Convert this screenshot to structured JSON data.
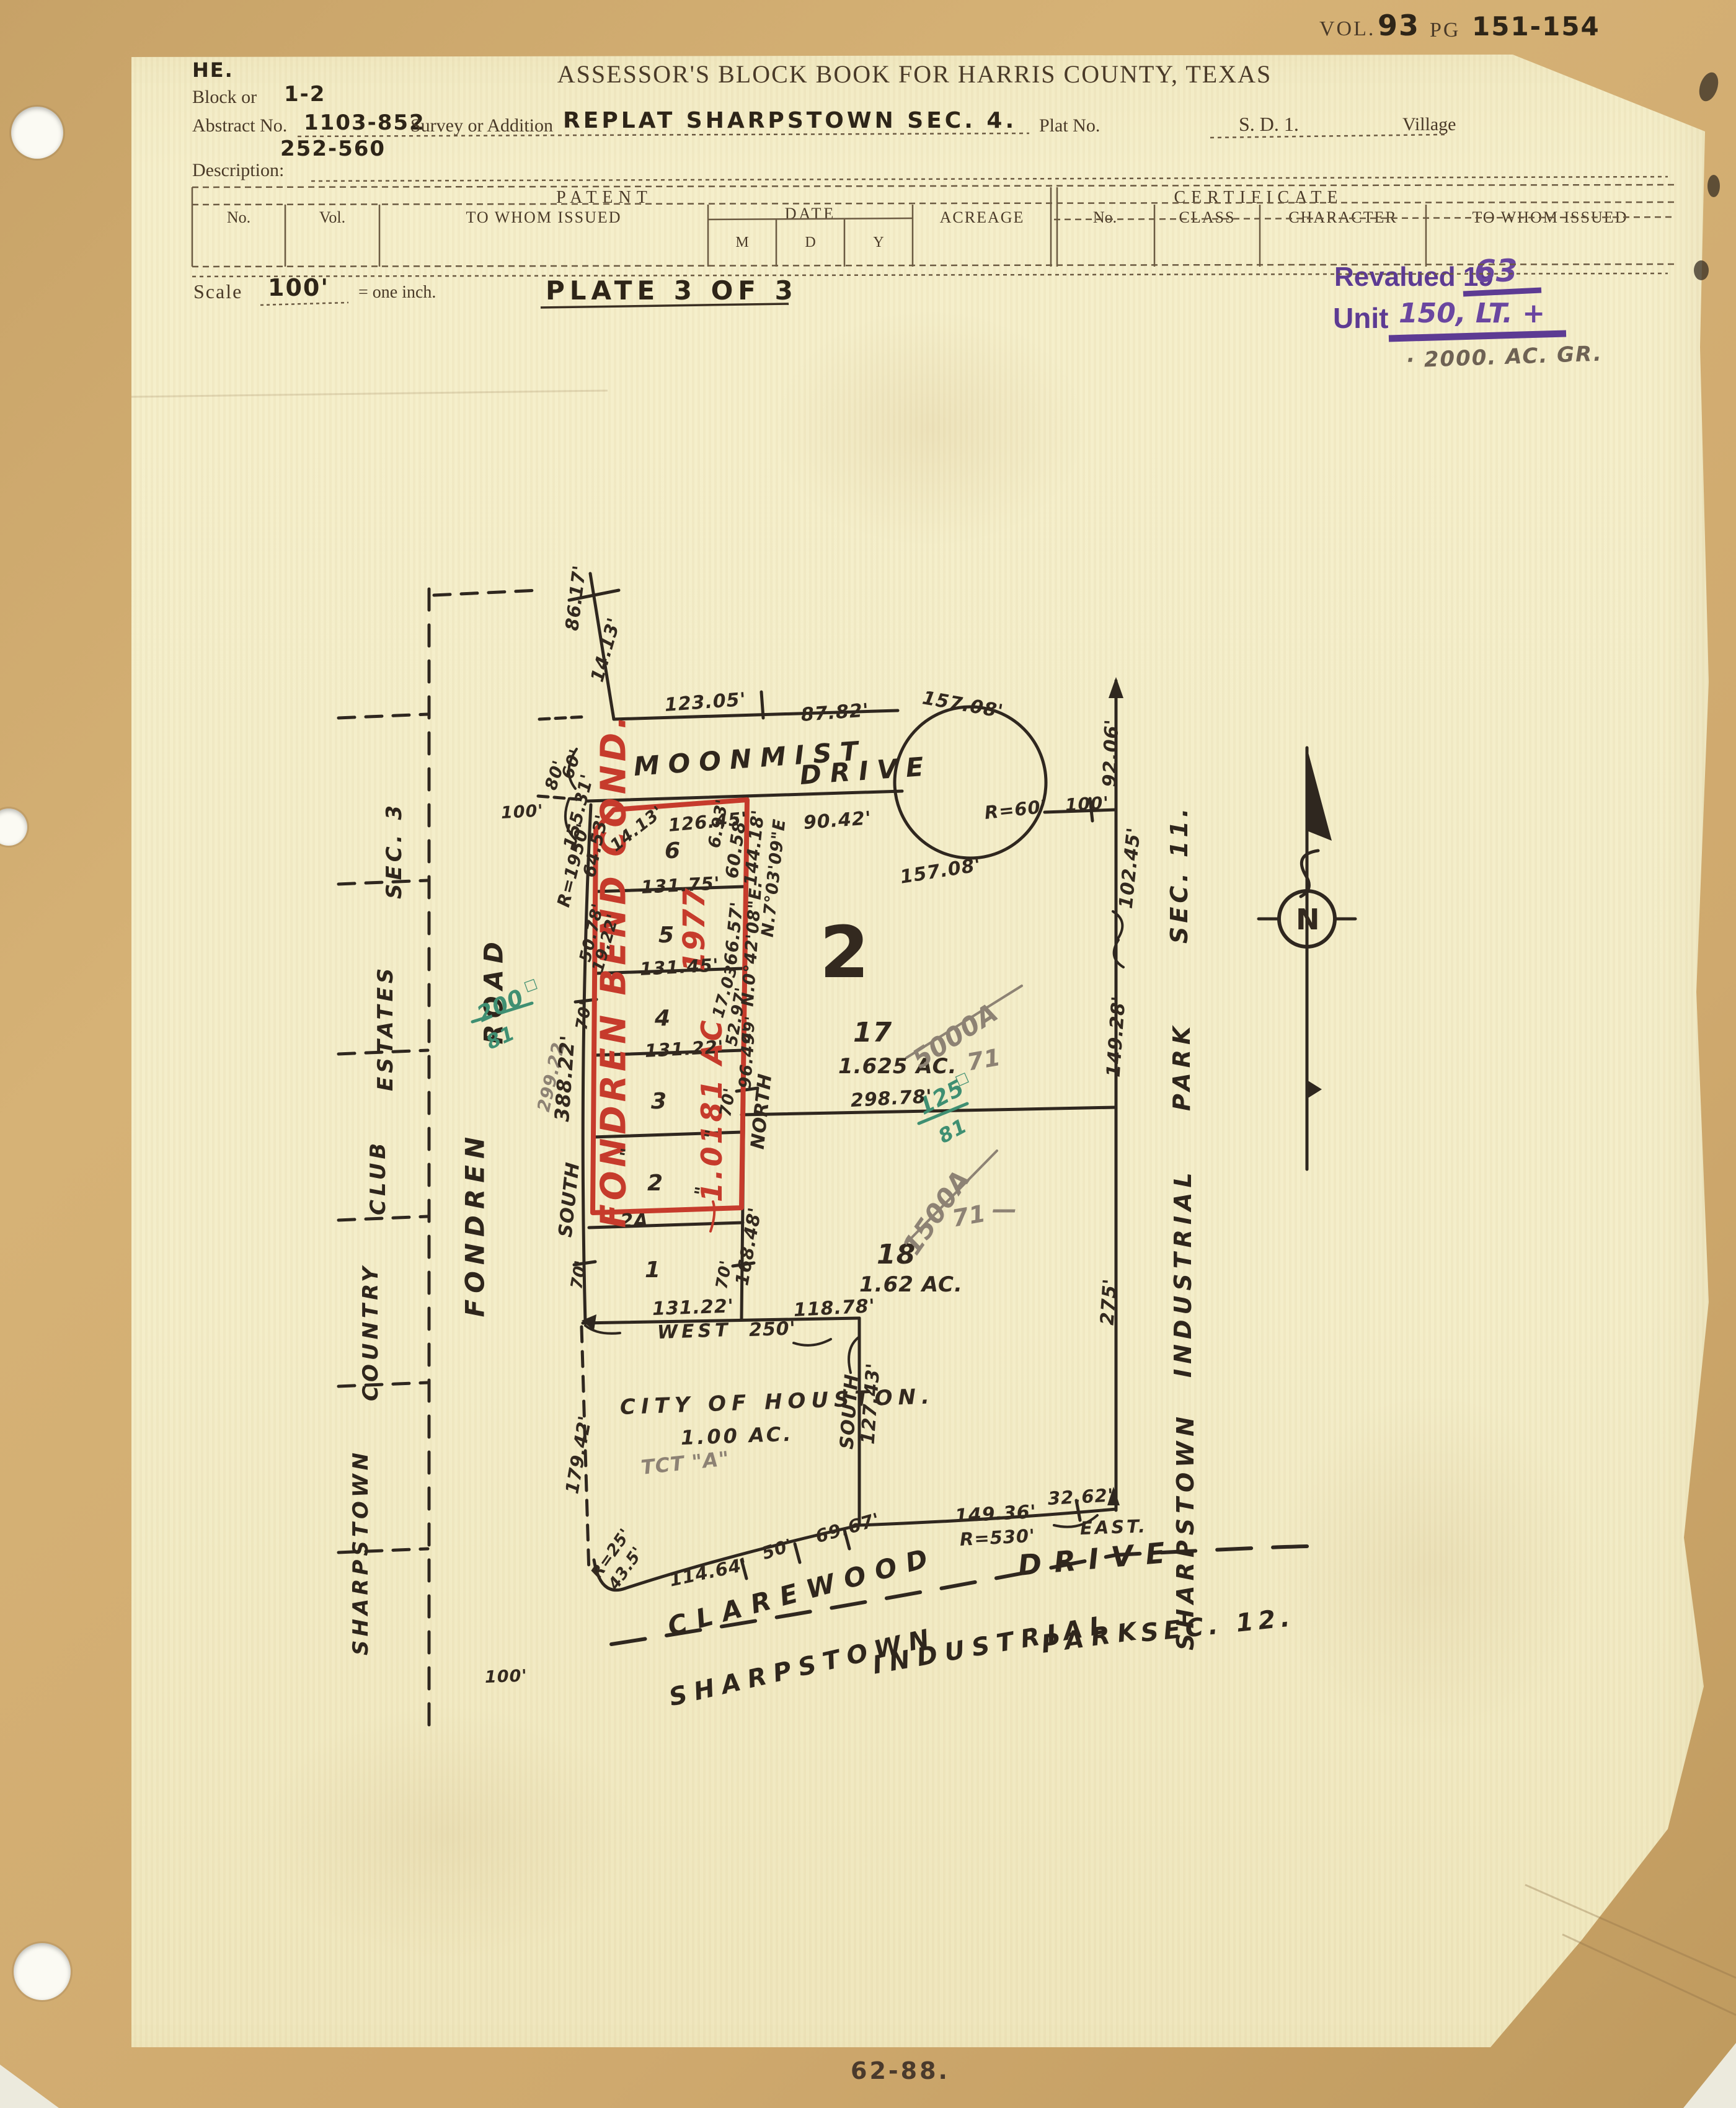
{
  "page": {
    "vol_label": "VOL.",
    "vol_value": "93",
    "pg_label": "PG",
    "pg_value": "151-154",
    "title": "ASSESSOR'S BLOCK BOOK FOR HARRIS COUNTY, TEXAS",
    "initials": "HE.",
    "block_label": "Block or",
    "block_value": "1-2",
    "abstract_label": "Abstract No.",
    "abstract_value": "1103-852",
    "abstract_value2": "252-560",
    "survey_label": "Survey or Addition",
    "survey_value": "REPLAT  SHARPSTOWN  SEC. 4.",
    "plat_label": "Plat No.",
    "sd_value": "S. D. 1.",
    "village_label": "Village",
    "description_label": "Description:",
    "scale_label": "Scale",
    "scale_value": "100'",
    "scale_eq": "= one inch.",
    "plate_value": "PLATE 3 OF 3",
    "revalued_label": "Revalued 19",
    "revalued_value": "63",
    "unit_label": "Unit",
    "unit_value": "150, LT. +",
    "unit_note": "· 2000. AC. GR.",
    "footer_stamp": "62-88."
  },
  "table": {
    "patent_header": "PATENT",
    "certificate_header": "CERTIFICATE",
    "col_no": "No.",
    "col_vol": "Vol.",
    "col_towhom": "TO WHOM ISSUED",
    "col_date": "DATE",
    "col_m": "M",
    "col_d": "D",
    "col_y": "Y",
    "col_acreage": "ACREAGE",
    "col_no2": "No.",
    "col_class": "CLASS",
    "col_character": "CHARACTER",
    "col_towhom2": "TO WHOM ISSUED"
  },
  "map": {
    "streets": {
      "moonmist_1": "MOONMIST",
      "moonmist_2": "DRIVE",
      "clarewood_1": "CLAREWOOD",
      "clarewood_2": "DRIVE",
      "fondren_1": "FONDREN",
      "fondren_2": "ROAD",
      "park11": [
        "SHARPSTOWN",
        "INDUSTRIAL",
        "PARK",
        "SEC. 11."
      ],
      "park12": [
        "SHARPSTOWN",
        "INDUSTRIAL",
        "PARK",
        "SEC. 12."
      ],
      "estates3": [
        "SHARPSTOWN",
        "COUNTRY",
        "CLUB",
        "ESTATES",
        "SEC. 3"
      ]
    },
    "parcels": {
      "block_number": "2",
      "lot17_number": "17",
      "lot17_acreage": "1.625 AC.",
      "lot18_number": "18",
      "lot18_acreage": "1.62 AC.",
      "city_owner": "CITY OF HOUSTON.",
      "city_acreage": "1.00 AC.",
      "red_lot_numbers": [
        "6",
        "5",
        "4",
        "3",
        "2",
        "2A",
        "1"
      ]
    },
    "dims": [
      "86.17'",
      "14.13'",
      "123.05'",
      "87.82'",
      "157.08'",
      "157.08'",
      "90.42'",
      "100'",
      "92.06'",
      "102.45'",
      "149.28'",
      "275'",
      "298.78'",
      "60'",
      "80'",
      "100'",
      "126.45'",
      "14.13'",
      "6.93'",
      "60.58'",
      "144.18'",
      "N.7°03'09\"E",
      "N.0°42'08\"E.",
      "66.57'",
      "17.03'",
      "52.97'",
      "49'",
      "96.49'",
      "NORTH",
      "168.48'",
      "70'",
      "70'",
      "70'",
      "70'",
      "131.75'",
      "131.45'",
      "131.22'",
      "155.31'",
      "R=1950'",
      "64.53'",
      "50.78'",
      "19.22'",
      "388.22'",
      "SOUTH",
      "131.22'",
      "WEST",
      "250'",
      "118.78'",
      "SOUTH",
      "127.43'",
      "179.42'",
      "R=25'",
      "43.5'",
      "114.64'",
      "50'",
      "69.67'",
      "149.36'",
      "R=530'",
      "32.62'",
      "EAST.",
      "100'",
      "R=60'",
      "\"",
      "\"",
      "\""
    ],
    "annotations": {
      "red": {
        "name": "FONDREN BEND COND.",
        "year": "1977",
        "acreage": "1.0181 AC"
      },
      "pencil": [
        "5000A",
        "71",
        "1500A",
        "71",
        "299.22",
        "TCT \"A\"",
        "—"
      ],
      "green": [
        "200",
        "81",
        "125",
        "81",
        "□",
        "□"
      ],
      "compass_north": "N"
    }
  }
}
